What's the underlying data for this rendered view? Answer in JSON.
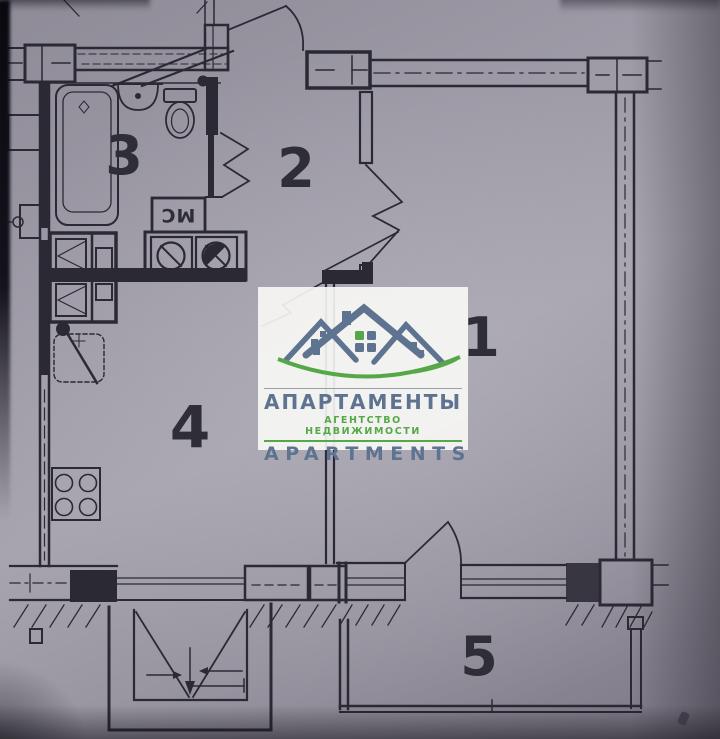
{
  "photo": {
    "paper_color": "#a4a1ad",
    "ink_color": "#2b2933"
  },
  "rooms": [
    {
      "id": "room-1",
      "number": "1"
    },
    {
      "id": "room-2",
      "number": "2"
    },
    {
      "id": "room-3",
      "number": "3"
    },
    {
      "id": "room-4",
      "number": "4"
    },
    {
      "id": "room-5",
      "number": "5"
    }
  ],
  "annotations": {
    "washing_machine_label": "МС"
  },
  "watermark": {
    "title_ru": "АПАРТАМЕНТЫ",
    "subtitle_ru": "АГЕНТСТВО НЕДВИЖИМОСТИ",
    "title_en": "APARTMENTS",
    "brand_slate": "#5e7390",
    "accent_green": "#56a748"
  }
}
